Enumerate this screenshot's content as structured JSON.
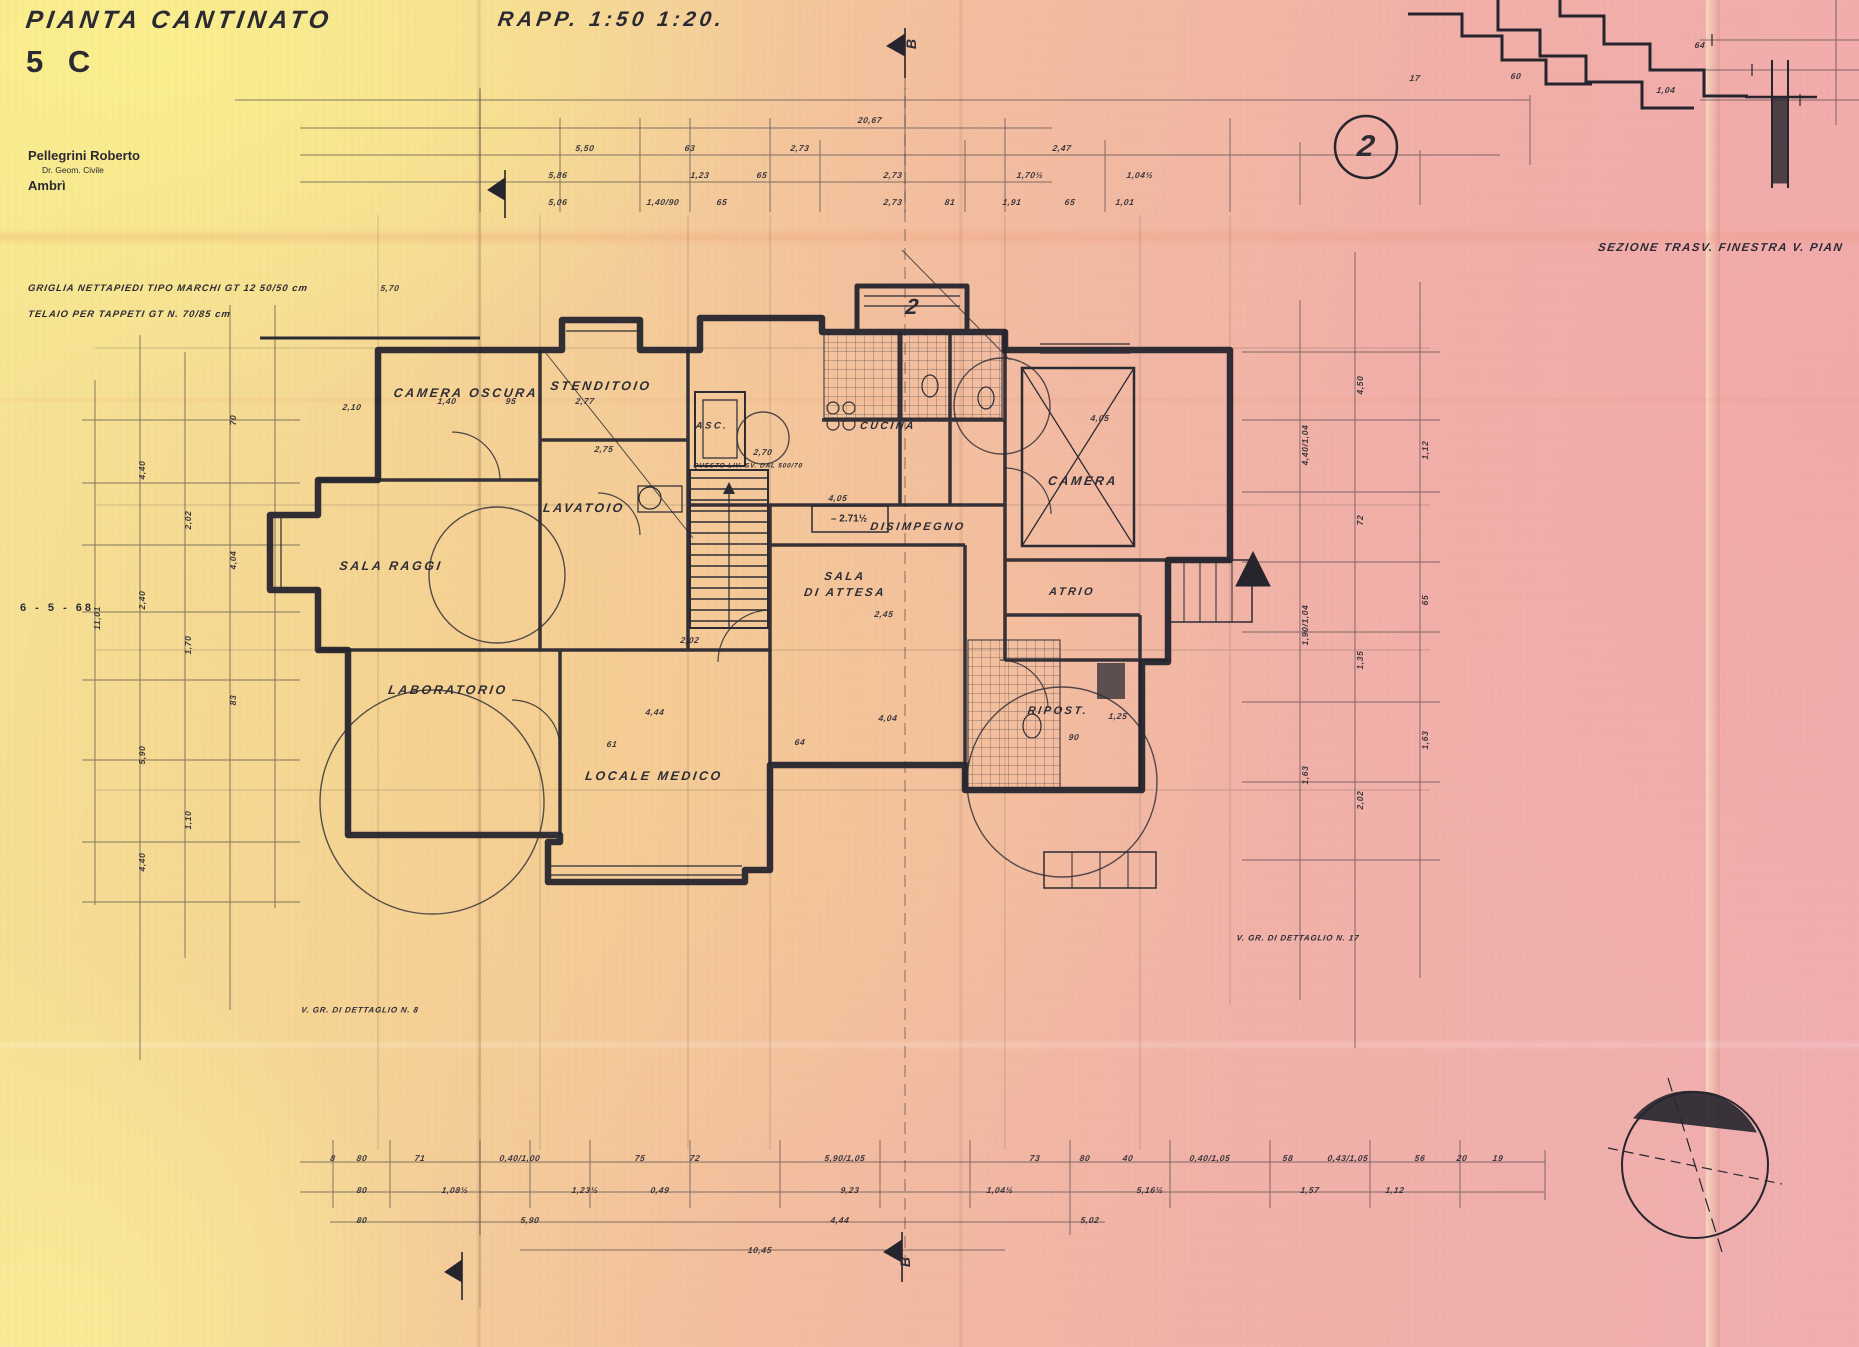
{
  "sheet": {
    "title": "PIANTA CANTINATO",
    "number": "5 C",
    "scale_note": "RAPP. 1:50 1:20.",
    "date": "6 - 5 - 68",
    "author1": "Pellegrini Roberto",
    "author2": "Dr. Geom. Civile",
    "author3": "Ambrì",
    "note1": "GRIGLIA NETTAPIEDI TIPO MARCHI GT 12  50/50 cm",
    "note2": "TELAIO PER TAPPETI GT N. 70/85 cm",
    "section_caption": "SEZIONE TRASV. FINESTRA V. PIAN",
    "level_label": "– 2.71½"
  },
  "rooms": [
    {
      "t": "CAMERA OSCURA",
      "x": 466,
      "y": 393
    },
    {
      "t": "STENDITOIO",
      "x": 601,
      "y": 386
    },
    {
      "t": "LAVATOIO",
      "x": 584,
      "y": 508
    },
    {
      "t": "SALA RAGGI",
      "x": 391,
      "y": 566
    },
    {
      "t": "LABORATORIO",
      "x": 448,
      "y": 690
    },
    {
      "t": "LOCALE MEDICO",
      "x": 654,
      "y": 776
    },
    {
      "t": "SALA",
      "x": 845,
      "y": 577,
      "s": 11.5
    },
    {
      "t": "DI ATTESA",
      "x": 845,
      "y": 593,
      "s": 11.5
    },
    {
      "t": "DISIMPEGNO",
      "x": 918,
      "y": 527,
      "s": 11
    },
    {
      "t": "CUCINA",
      "x": 888,
      "y": 426,
      "s": 10.5
    },
    {
      "t": "CAMERA",
      "x": 1083,
      "y": 481
    },
    {
      "t": "ATRIO",
      "x": 1072,
      "y": 592,
      "s": 11
    },
    {
      "t": "RIPOST.",
      "x": 1058,
      "y": 711,
      "s": 11
    },
    {
      "t": "ASC.",
      "x": 712,
      "y": 426,
      "s": 9.5
    }
  ],
  "annotations": [
    {
      "t": "V. GR. DI DETTAGLIO N. 8",
      "x": 360,
      "y": 1010
    },
    {
      "t": "V. GR. DI DETTAGLIO N. 17",
      "x": 1298,
      "y": 938
    },
    {
      "t": "QUESTO LIV. SV. DAL 500/70",
      "x": 748,
      "y": 466,
      "s": 6.5
    }
  ],
  "markers": [
    {
      "t": "2",
      "x": 1366,
      "y": 147,
      "s": 30
    },
    {
      "t": "2",
      "x": 912,
      "y": 307,
      "s": 22
    },
    {
      "t": "B",
      "x": 911,
      "y": 44,
      "s": 14,
      "r": -90
    },
    {
      "t": "B",
      "x": 905,
      "y": 1262,
      "s": 14,
      "r": -90
    }
  ],
  "dims": [
    {
      "t": "20,67",
      "x": 870,
      "y": 120
    },
    {
      "t": "5,50",
      "x": 585,
      "y": 148
    },
    {
      "t": "63",
      "x": 690,
      "y": 148
    },
    {
      "t": "2,73",
      "x": 800,
      "y": 148
    },
    {
      "t": "2,47",
      "x": 1062,
      "y": 148
    },
    {
      "t": "5,86",
      "x": 558,
      "y": 175
    },
    {
      "t": "1,23",
      "x": 700,
      "y": 175
    },
    {
      "t": "65",
      "x": 762,
      "y": 175
    },
    {
      "t": "2,73",
      "x": 893,
      "y": 175
    },
    {
      "t": "1,70½",
      "x": 1030,
      "y": 175
    },
    {
      "t": "1,04½",
      "x": 1140,
      "y": 175
    },
    {
      "t": "5,06",
      "x": 558,
      "y": 202
    },
    {
      "t": "1,40/90",
      "x": 663,
      "y": 202
    },
    {
      "t": "65",
      "x": 722,
      "y": 202
    },
    {
      "t": "2,73",
      "x": 893,
      "y": 202
    },
    {
      "t": "81",
      "x": 950,
      "y": 202
    },
    {
      "t": "1,91",
      "x": 1012,
      "y": 202
    },
    {
      "t": "65",
      "x": 1070,
      "y": 202
    },
    {
      "t": "1,01",
      "x": 1125,
      "y": 202
    },
    {
      "t": "17",
      "x": 1415,
      "y": 78
    },
    {
      "t": "60",
      "x": 1516,
      "y": 76
    },
    {
      "t": "1,04",
      "x": 1666,
      "y": 90
    },
    {
      "t": "64",
      "x": 1700,
      "y": 45
    },
    {
      "t": "5,70",
      "x": 390,
      "y": 288
    },
    {
      "t": "2,10",
      "x": 352,
      "y": 407
    },
    {
      "t": "1,40",
      "x": 447,
      "y": 401
    },
    {
      "t": "95",
      "x": 511,
      "y": 401
    },
    {
      "t": "2,77",
      "x": 585,
      "y": 401
    },
    {
      "t": "2,75",
      "x": 604,
      "y": 449
    },
    {
      "t": "2,70",
      "x": 763,
      "y": 452
    },
    {
      "t": "4,05",
      "x": 838,
      "y": 498
    },
    {
      "t": "2,45",
      "x": 884,
      "y": 614
    },
    {
      "t": "4,44",
      "x": 655,
      "y": 712
    },
    {
      "t": "4,04",
      "x": 888,
      "y": 718
    },
    {
      "t": "64",
      "x": 800,
      "y": 742
    },
    {
      "t": "4,05",
      "x": 1100,
      "y": 418
    },
    {
      "t": "1,25",
      "x": 1118,
      "y": 716
    },
    {
      "t": "90",
      "x": 1074,
      "y": 737
    },
    {
      "t": "61",
      "x": 612,
      "y": 744
    },
    {
      "t": "2,02",
      "x": 690,
      "y": 640
    },
    {
      "t": "4,40",
      "x": 142,
      "y": 470,
      "r": -90
    },
    {
      "t": "2,40",
      "x": 142,
      "y": 600,
      "r": -90
    },
    {
      "t": "5,90",
      "x": 142,
      "y": 755,
      "r": -90
    },
    {
      "t": "4,40",
      "x": 142,
      "y": 862,
      "r": -90
    },
    {
      "t": "2,02",
      "x": 188,
      "y": 520,
      "r": -90
    },
    {
      "t": "1,70",
      "x": 188,
      "y": 645,
      "r": -90
    },
    {
      "t": "1,10",
      "x": 188,
      "y": 820,
      "r": -90
    },
    {
      "t": "70",
      "x": 233,
      "y": 420,
      "r": -90
    },
    {
      "t": "4,04",
      "x": 233,
      "y": 560,
      "r": -90
    },
    {
      "t": "83",
      "x": 233,
      "y": 700,
      "r": -90
    },
    {
      "t": "11,01",
      "x": 97,
      "y": 618,
      "r": -90
    },
    {
      "t": "4,40/1,04",
      "x": 1305,
      "y": 445,
      "r": -90
    },
    {
      "t": "1,90/1,04",
      "x": 1305,
      "y": 625,
      "r": -90
    },
    {
      "t": "1,63",
      "x": 1305,
      "y": 775,
      "r": -90
    },
    {
      "t": "4,50",
      "x": 1360,
      "y": 385,
      "r": -90
    },
    {
      "t": "72",
      "x": 1360,
      "y": 520,
      "r": -90
    },
    {
      "t": "1,35",
      "x": 1360,
      "y": 660,
      "r": -90
    },
    {
      "t": "2,02",
      "x": 1360,
      "y": 800,
      "r": -90
    },
    {
      "t": "1,12",
      "x": 1425,
      "y": 450,
      "r": -90
    },
    {
      "t": "65",
      "x": 1425,
      "y": 600,
      "r": -90
    },
    {
      "t": "1,63",
      "x": 1425,
      "y": 740,
      "r": -90
    },
    {
      "t": "8",
      "x": 333,
      "y": 1158
    },
    {
      "t": "80",
      "x": 362,
      "y": 1158
    },
    {
      "t": "71",
      "x": 420,
      "y": 1158
    },
    {
      "t": "0,40/1,00",
      "x": 520,
      "y": 1158
    },
    {
      "t": "75",
      "x": 640,
      "y": 1158
    },
    {
      "t": "72",
      "x": 695,
      "y": 1158
    },
    {
      "t": "5,90/1,05",
      "x": 845,
      "y": 1158
    },
    {
      "t": "73",
      "x": 1035,
      "y": 1158
    },
    {
      "t": "80",
      "x": 1085,
      "y": 1158
    },
    {
      "t": "40",
      "x": 1128,
      "y": 1158
    },
    {
      "t": "0,40/1,05",
      "x": 1210,
      "y": 1158
    },
    {
      "t": "58",
      "x": 1288,
      "y": 1158
    },
    {
      "t": "0,43/1,05",
      "x": 1348,
      "y": 1158
    },
    {
      "t": "56",
      "x": 1420,
      "y": 1158
    },
    {
      "t": "20",
      "x": 1462,
      "y": 1158
    },
    {
      "t": "19",
      "x": 1498,
      "y": 1158
    },
    {
      "t": "80",
      "x": 362,
      "y": 1190
    },
    {
      "t": "1,08½",
      "x": 455,
      "y": 1190
    },
    {
      "t": "1,23½",
      "x": 585,
      "y": 1190
    },
    {
      "t": "0,49",
      "x": 660,
      "y": 1190
    },
    {
      "t": "9,23",
      "x": 850,
      "y": 1190
    },
    {
      "t": "1,04½",
      "x": 1000,
      "y": 1190
    },
    {
      "t": "5,16½",
      "x": 1150,
      "y": 1190
    },
    {
      "t": "1,57",
      "x": 1310,
      "y": 1190
    },
    {
      "t": "1,12",
      "x": 1395,
      "y": 1190
    },
    {
      "t": "80",
      "x": 362,
      "y": 1220
    },
    {
      "t": "5,90",
      "x": 530,
      "y": 1220
    },
    {
      "t": "4,44",
      "x": 840,
      "y": 1220
    },
    {
      "t": "5,02",
      "x": 1090,
      "y": 1220
    },
    {
      "t": "10,45",
      "x": 760,
      "y": 1250
    }
  ]
}
